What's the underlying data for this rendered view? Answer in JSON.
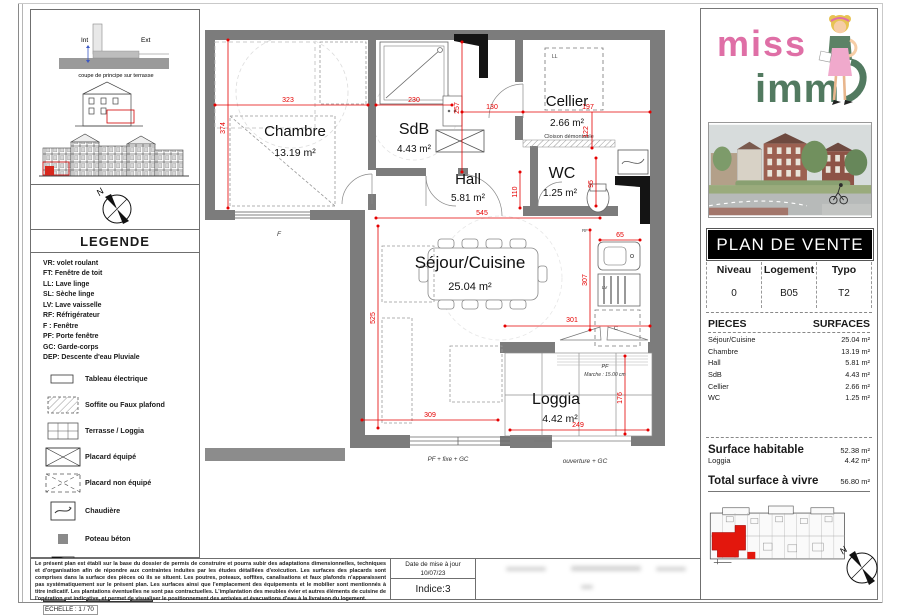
{
  "coupe": {
    "int_label": "Int",
    "ext_label": "Ext",
    "caption": "coupe de principe sur terrasse"
  },
  "compass": {
    "north": "N"
  },
  "legend": {
    "title": "LEGENDE",
    "abbr": [
      "VR: volet roulant",
      "FT: Fenêtre de toit",
      "LL:  Lave linge",
      "SL: Sèche linge",
      "LV: Lave vaisselle",
      "RF: Réfrigérateur",
      "F : Fenêtre",
      "PF: Porte fenêtre",
      "GC: Garde-corps",
      "DEP: Descente d'eau Pluviale"
    ],
    "symbols": [
      {
        "icon": "tableau-electrique",
        "label": "Tableau électrique"
      },
      {
        "icon": "soffite-faux-plafond",
        "label": "Soffite ou Faux plafond"
      },
      {
        "icon": "terrasse-loggia",
        "label": "Terrasse / Loggia"
      },
      {
        "icon": "placard-equipe",
        "label": "Placard équipé"
      },
      {
        "icon": "placard-non-equipe",
        "label": "Placard  non équipé"
      },
      {
        "icon": "chaudiere",
        "label": "Chaudière"
      },
      {
        "icon": "poteau-beton",
        "label": "Poteau béton"
      },
      {
        "icon": "gaine-technique",
        "label": "Gaine technique"
      }
    ],
    "scale_ticks": [
      "0.3 m",
      "0.6 m",
      "0.9 m",
      "1.2 m"
    ],
    "scale_end": "1.5 m",
    "echelle": "ECHELLE :   1 / 70"
  },
  "plan": {
    "rooms": [
      {
        "name": "Chambre",
        "area": "13.19 m²"
      },
      {
        "name": "SdB",
        "area": "4.43 m²"
      },
      {
        "name": "Hall",
        "area": "5.81 m²"
      },
      {
        "name": "Cellier",
        "area": "2.66 m²"
      },
      {
        "name": "WC",
        "area": "1.25 m²"
      },
      {
        "name": "Séjour/Cuisine",
        "area": "25.04 m²"
      },
      {
        "name": "Loggia",
        "area": "4.42 m²"
      }
    ],
    "dims": {
      "d323": "323",
      "d374": "374",
      "d230": "230",
      "d257": "257",
      "d110": "110",
      "d130": "130",
      "d197": "197",
      "d122": "122",
      "d95": "95",
      "d545": "545",
      "d525": "525",
      "d309": "309",
      "d301": "301",
      "d307": "307",
      "d65": "65",
      "d176": "176",
      "d249": "249"
    },
    "notes": {
      "cloison": "Cloison démontable",
      "window_f": "F",
      "pf": "PF",
      "marche": "Marche : 15.00 cm",
      "pf_fixe_gc": "PF + fixe + GC",
      "ouverture_gc": "ouverture + GC",
      "ll": "LL",
      "lv": "LV",
      "c": "C",
      "rf": "RF"
    }
  },
  "panel": {
    "logo_line1": "miss",
    "logo_line2": "imm",
    "title": "PLAN DE VENTE",
    "info": {
      "headers": [
        "Niveau",
        "Logement",
        "Typo"
      ],
      "values": [
        "0",
        "B05",
        "T2"
      ]
    },
    "pieces": {
      "col_left": "PIECES",
      "col_right": "SURFACES",
      "rows": [
        {
          "name": "Séjour/Cuisine",
          "area": "25.04 m²"
        },
        {
          "name": "Chambre",
          "area": "13.19 m²"
        },
        {
          "name": "Hall",
          "area": "5.81 m²"
        },
        {
          "name": "SdB",
          "area": "4.43 m²"
        },
        {
          "name": "Cellier",
          "area": "2.66 m²"
        },
        {
          "name": "WC",
          "area": "1.25 m²"
        }
      ]
    },
    "surfaces": {
      "habitable_label": "Surface habitable",
      "habitable_value": "52.38 m²",
      "loggia_label": "Loggia",
      "loggia_value": "4.42 m²",
      "total_label": "Total surface à vivre",
      "total_value": "56.80 m²"
    },
    "north": "N"
  },
  "titleblock": {
    "disclaimer": "Le présent plan est établi sur la base du dossier de permis de construire et pourra subir des adaptations dimensionnelles, techniques et d'organisation afin de répondre aux contraintes induites par les études détaillées d'exécution. Les surfaces des placards sont comprises dans la surface des pièces où ils se situent. Les poutres, poteaux, soffites, canalisations et faux plafonds n'apparaissent pas systématiquement sur le présent plan. Les surfaces ainsi que l'emplacement des équipements et le mobilier sont mentionnés à titre indicatif. Les plantations éventuelles ne sont pas contractuelles. L'implantation des meubles évier et autres éléments de cuisine de l'opération est indicative, et permet de visualiser le positionnement des arrivées et évacuations d'eau à la livraison du logement.",
    "date_label": "Date de mise à jour",
    "date_value": "10/07/23",
    "indice": "Indice:3"
  }
}
